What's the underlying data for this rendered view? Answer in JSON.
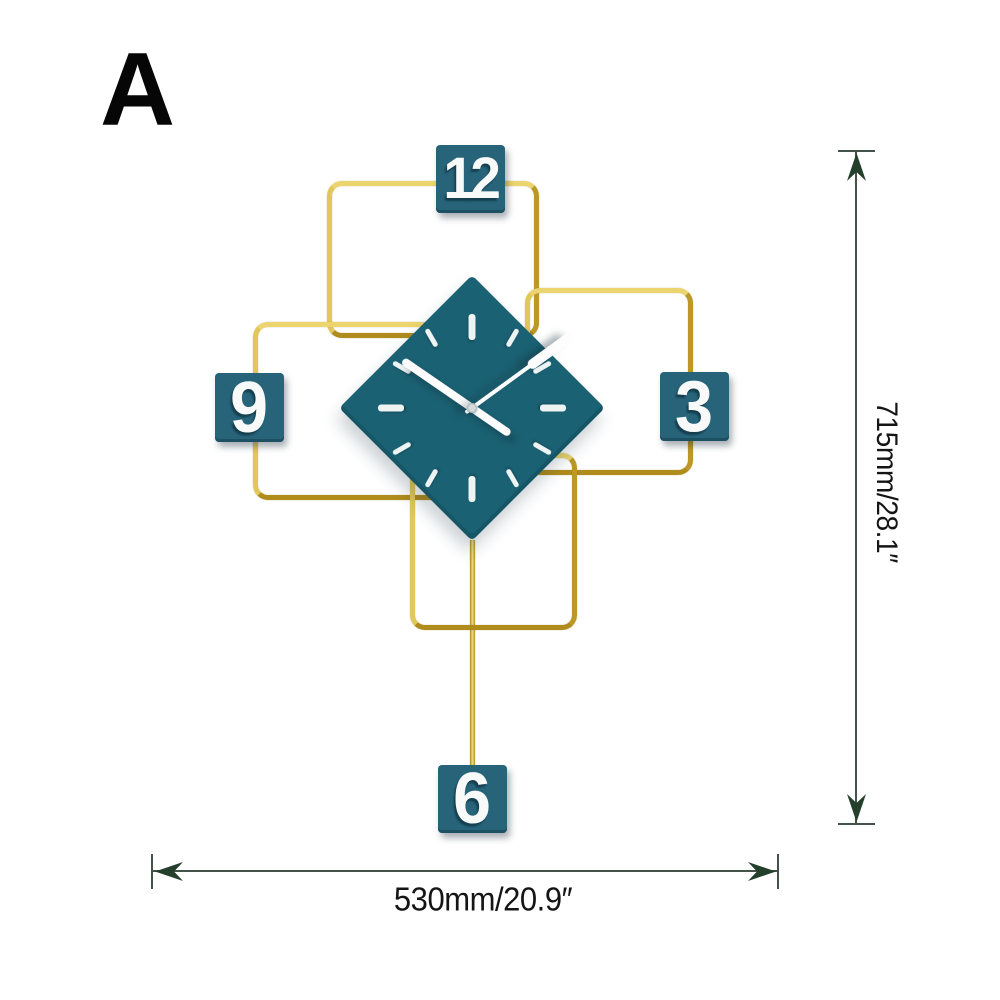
{
  "variant_label": "A",
  "clock": {
    "time": "10:09",
    "numbers": {
      "top": "12",
      "right": "3",
      "bottom": "6",
      "left": "9"
    }
  },
  "annotations": {
    "height_label": "715mm/28.1″",
    "width_label": "530mm/20.9″"
  },
  "colors": {
    "face_teal": "#1a6173",
    "plate_teal": "#27647a",
    "gold": "#d7b440",
    "tick_white": "#eef4f3",
    "hand_white": "#fdfdfd",
    "dim_line": "#43534a",
    "dim_arrow": "#24402c",
    "dim_text": "#151515"
  }
}
